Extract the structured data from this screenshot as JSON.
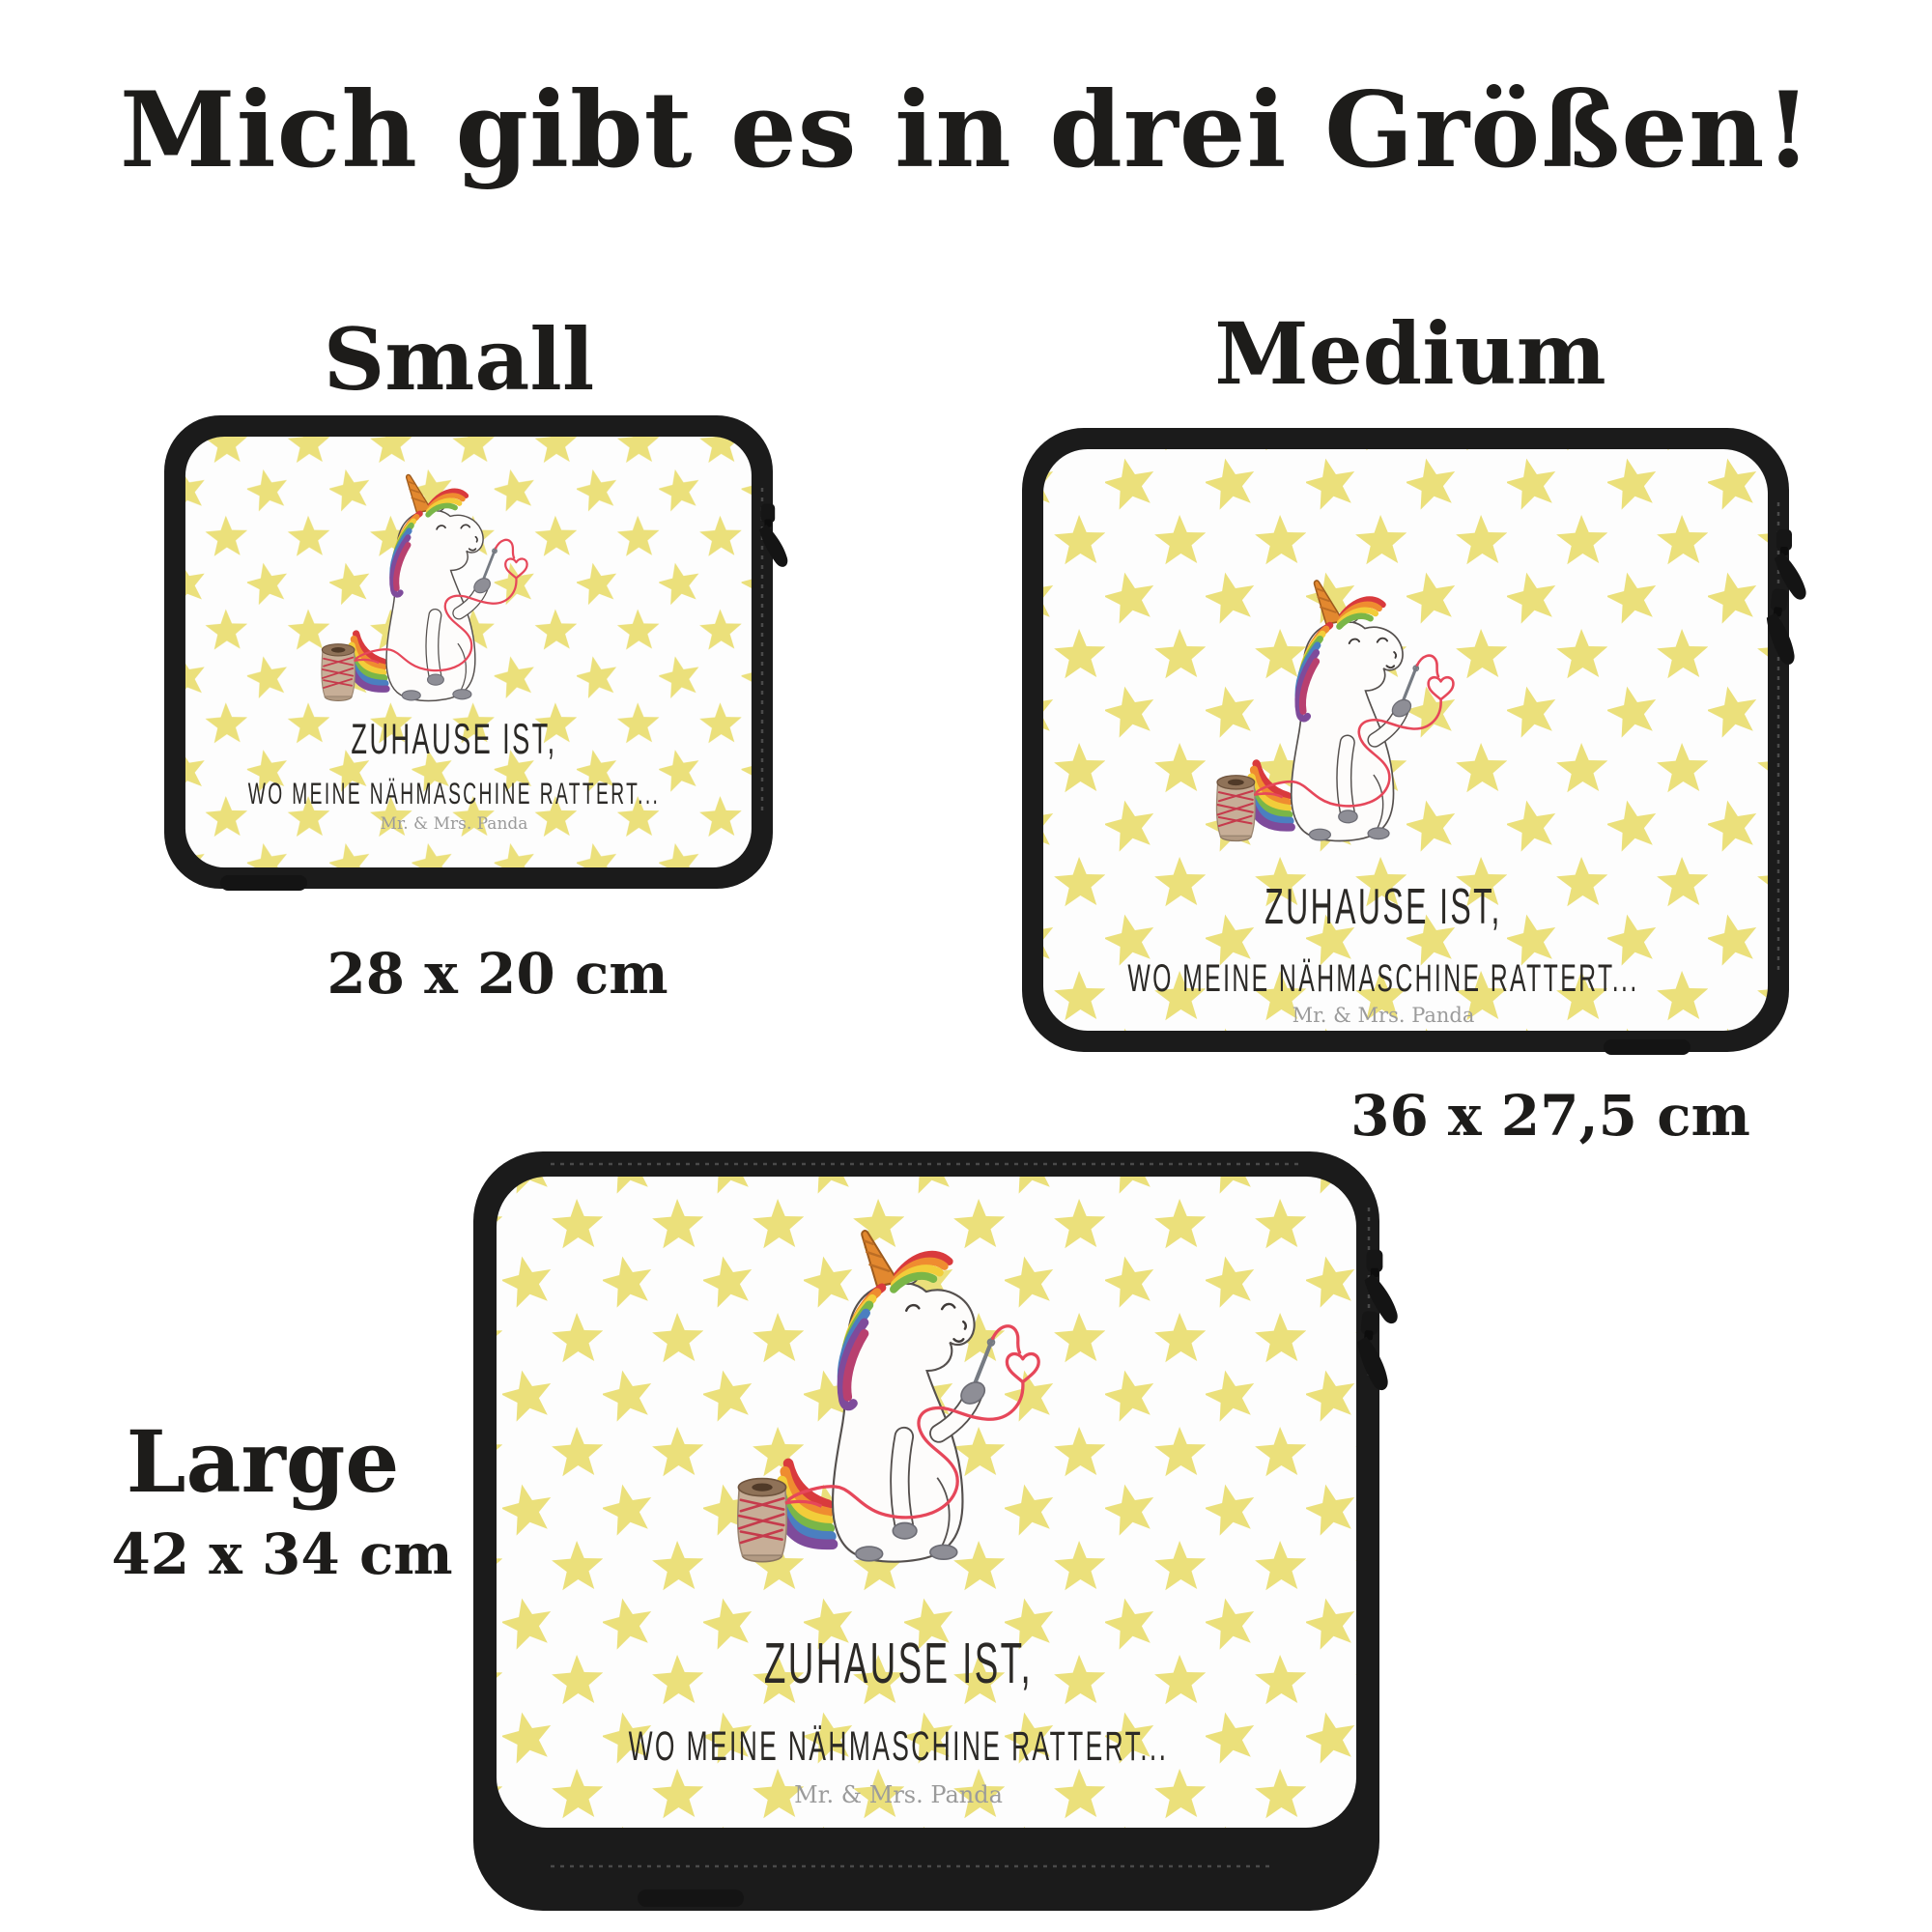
{
  "title": "Mich gibt es in drei Größen!",
  "products": [
    {
      "name": "Small",
      "size": "28 x 20 cm"
    },
    {
      "name": "Medium",
      "size": "36 x 27,5 cm"
    },
    {
      "name": "Large",
      "size": "42 x 34 cm"
    }
  ],
  "sleeve_print": {
    "quote_line1": "ZUHAUSE IST,",
    "quote_line2": "WO MEINE NÄHMASCHINE RATTERT...",
    "brand": "Mr. & Mrs. Panda"
  },
  "colors": {
    "background": "#ffffff",
    "text": "#1d1c1a",
    "star": "#ebe07b",
    "sleeve_border": "#1b1b1b",
    "panel": "#fdfdfd",
    "thread": "#e6475a",
    "horn": "#e2882f",
    "hoof": "#8e8e96",
    "brand_text": "#9b9b9b",
    "mane": [
      "#d93a3d",
      "#ef8c30",
      "#f2cd3a",
      "#7ab648",
      "#4b7fc0",
      "#7e4b9b",
      "#b8406f"
    ]
  }
}
